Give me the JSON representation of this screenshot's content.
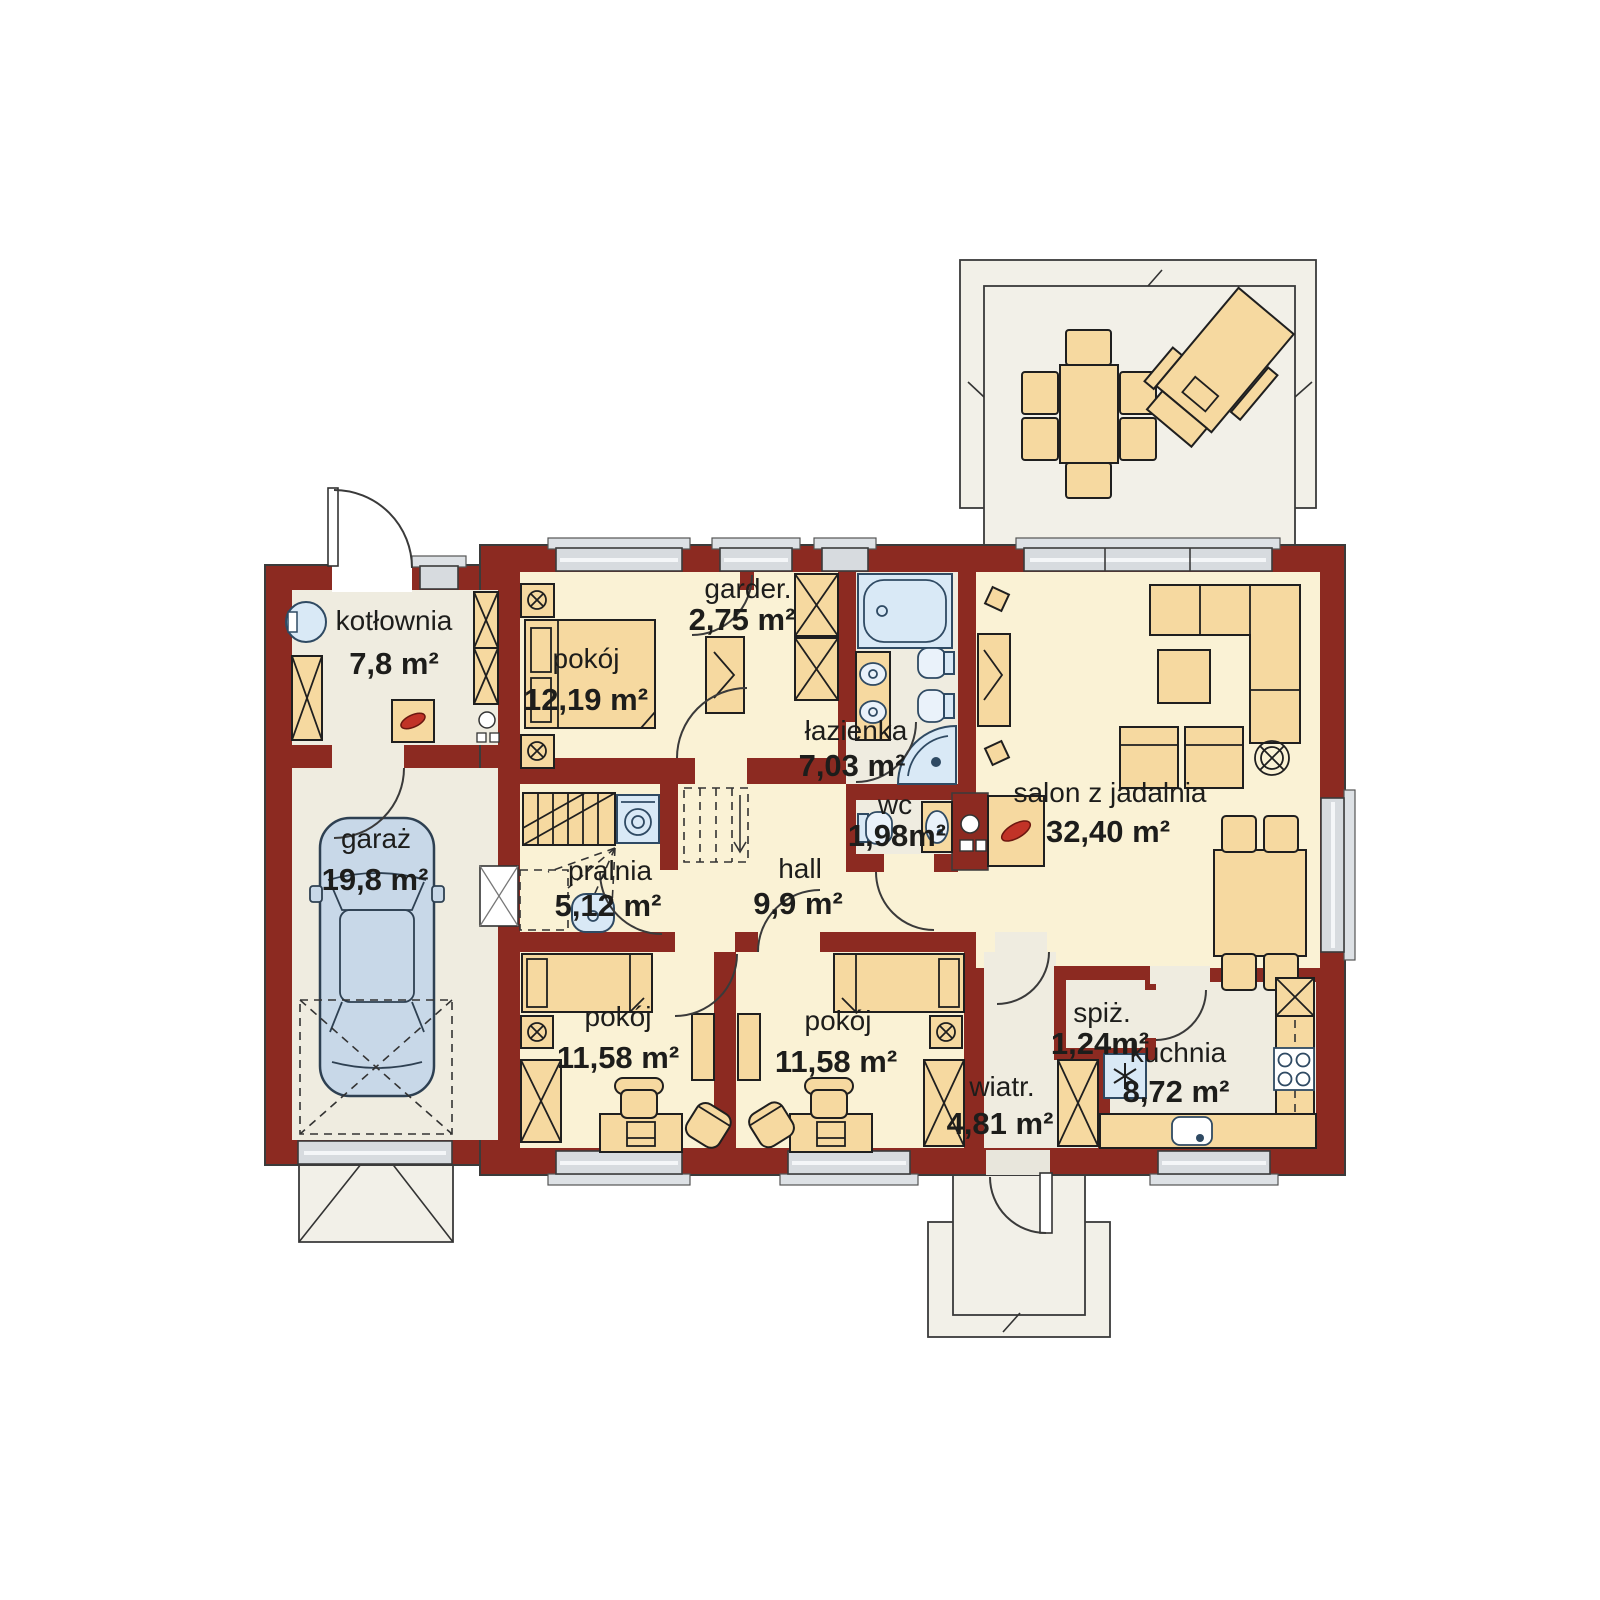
{
  "rooms": [
    {
      "id": "kotlownia",
      "name": "kotłownia",
      "area": "7,8 m²"
    },
    {
      "id": "pokoj-1",
      "name": "pokój",
      "area": "12,19 m²"
    },
    {
      "id": "garderoba",
      "name": "garder.",
      "area": "2,75 m²"
    },
    {
      "id": "lazienka",
      "name": "łazienka",
      "area": "7,03 m²"
    },
    {
      "id": "wc",
      "name": "wc",
      "area": "1,98m²"
    },
    {
      "id": "salon",
      "name": "salon z jadalnia",
      "area": "32,40 m²"
    },
    {
      "id": "garaz",
      "name": "garaż",
      "area": "19,8 m²"
    },
    {
      "id": "pralnia",
      "name": "pralnia",
      "area": "5,12 m²"
    },
    {
      "id": "hall",
      "name": "hall",
      "area": "9,9 m²"
    },
    {
      "id": "pokoj-2",
      "name": "pokój",
      "area": "11,58 m²"
    },
    {
      "id": "pokoj-3",
      "name": "pokój",
      "area": "11,58 m²"
    },
    {
      "id": "wiatrolap",
      "name": "wiatr.",
      "area": "4,81 m²"
    },
    {
      "id": "spizarnia",
      "name": "spiż.",
      "area": "1,24m²"
    },
    {
      "id": "kuchnia",
      "name": "kuchnia",
      "area": "8,72 m²"
    }
  ],
  "colors": {
    "wall": "#8C2A21",
    "floor_warm": "#FAF2D5",
    "floor_cool": "#EFECE0",
    "furniture": "#F6D9A0",
    "fixture_blue": "#D9E9F6",
    "outdoor": "#F2F0E8",
    "window": "#D7DBDF",
    "flame": "#C13327",
    "car": "#C8D8E8",
    "text": "#1D1D1B"
  }
}
